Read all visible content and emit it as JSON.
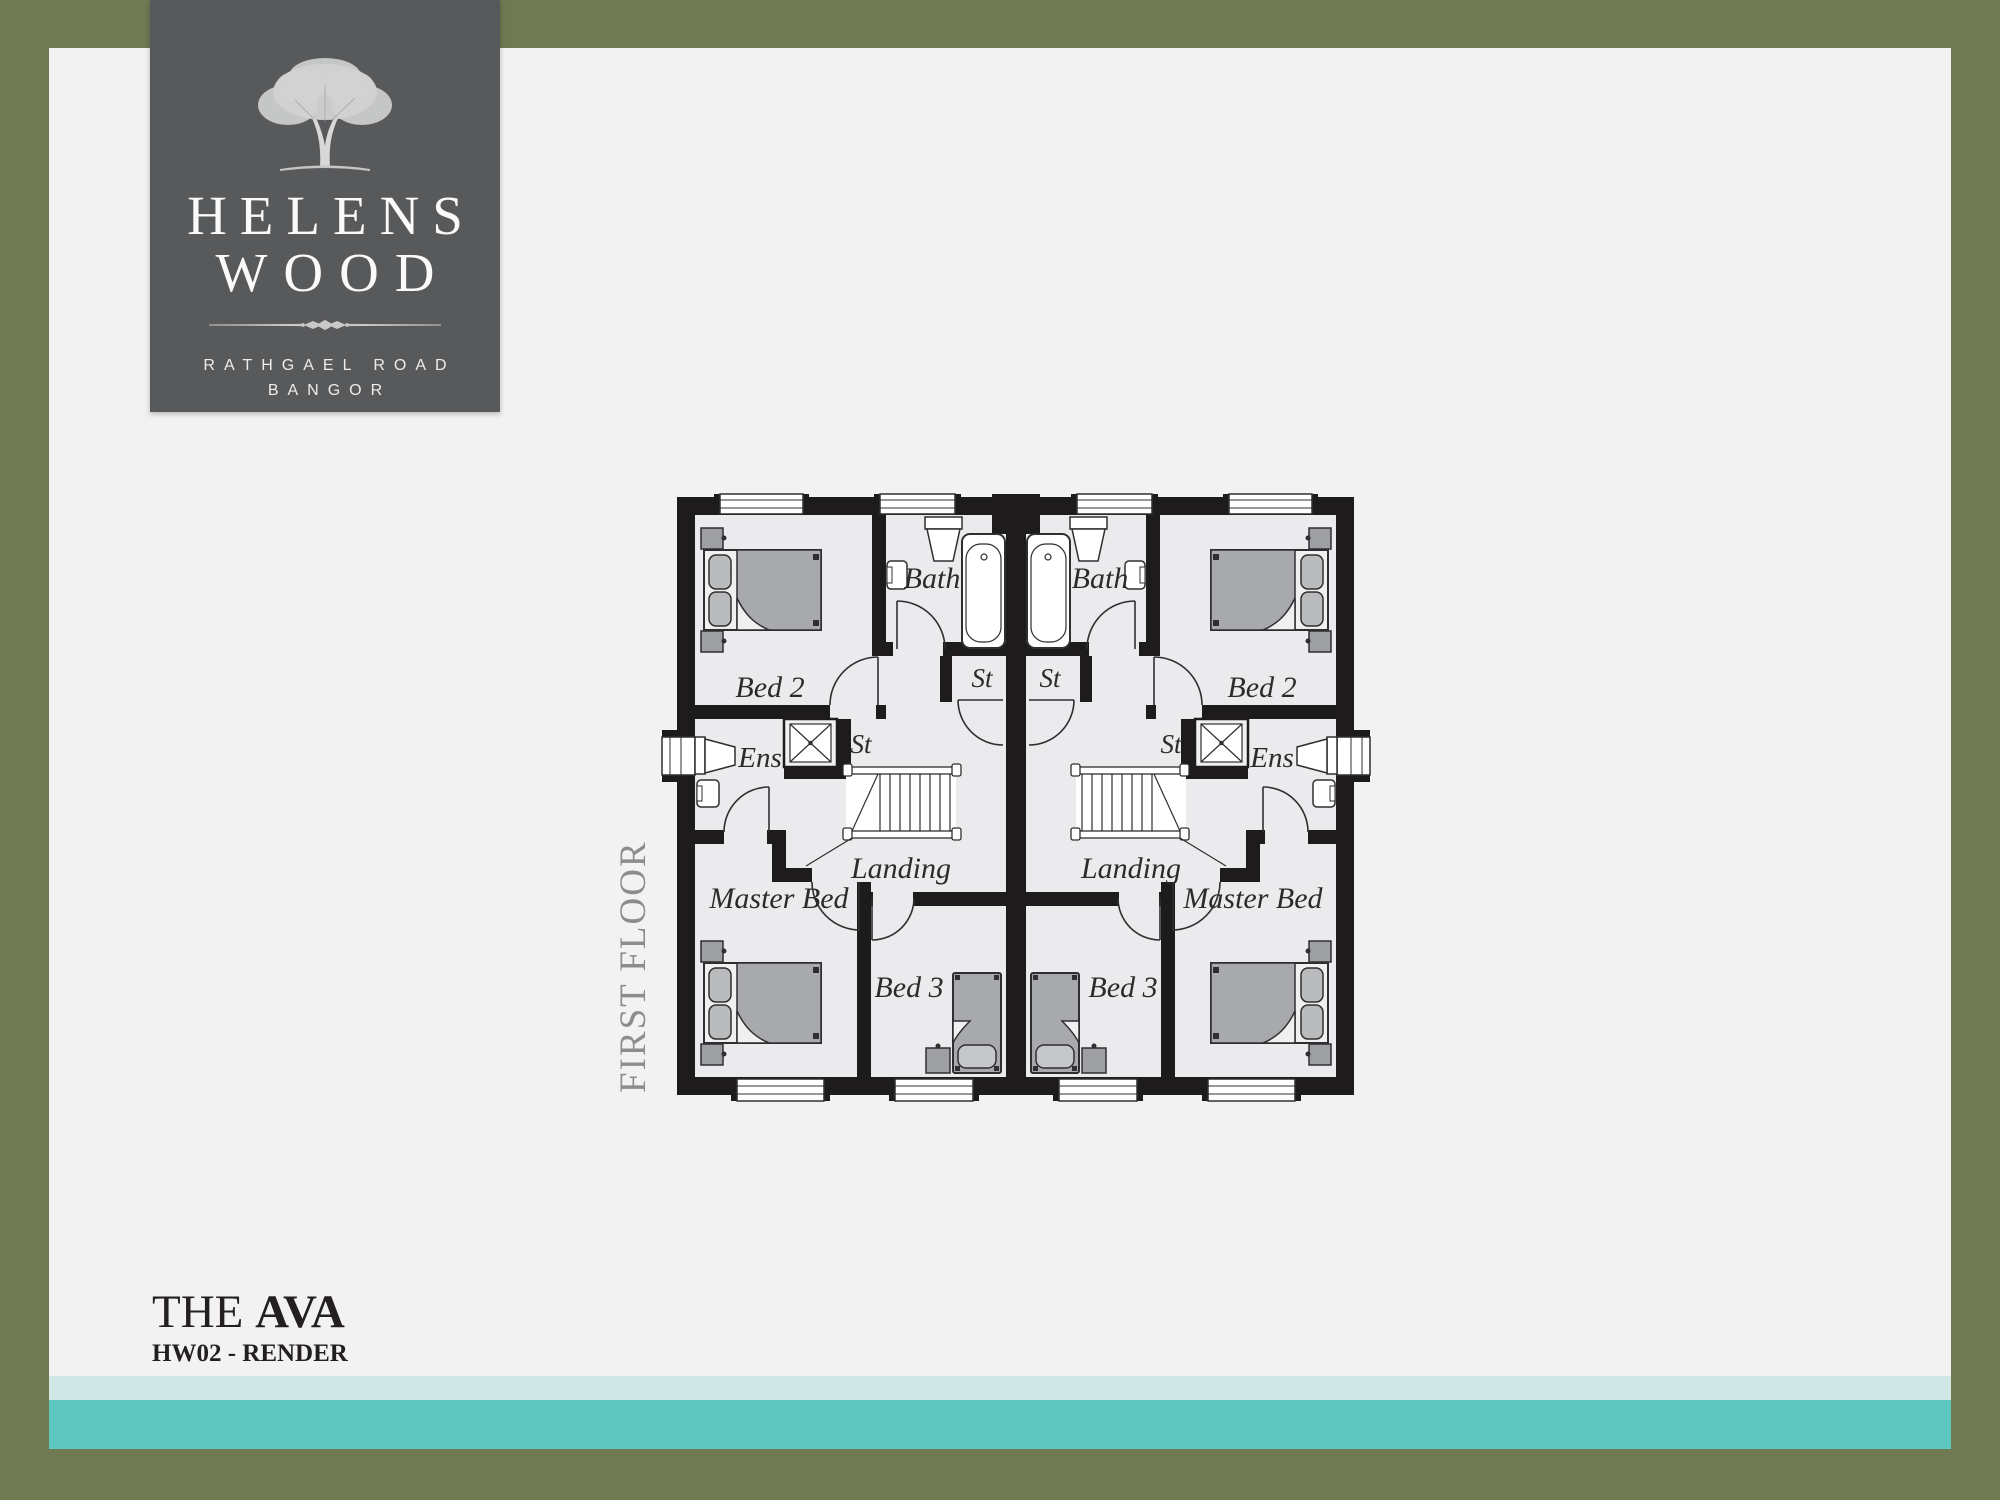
{
  "brand": {
    "name_line1": "HELENS",
    "name_line2": "WOOD",
    "address_line1": "RATHGAEL ROAD",
    "address_line2": "BANGOR"
  },
  "floor_plan": {
    "floor_label": "FIRST FLOOR",
    "rooms": {
      "bed2": "Bed 2",
      "bath": "Bath",
      "store": "St",
      "ensuite": "Ens",
      "master": "Master Bed",
      "landing": "Landing",
      "bed3": "Bed 3"
    }
  },
  "footer": {
    "house_prefix": "THE",
    "house_name": "AVA",
    "plot_code": "HW02 - RENDER"
  },
  "colors": {
    "border_olive": "#6f7a52",
    "background": "#f2f2f3",
    "logo_gray": "#58595b",
    "stripe_light_teal": "#cfe8e5",
    "stripe_teal": "#5ec8c0",
    "wall_black": "#1d1b1b",
    "room_fill": "#ebebed",
    "furniture_gray": "#a7a9ac"
  }
}
